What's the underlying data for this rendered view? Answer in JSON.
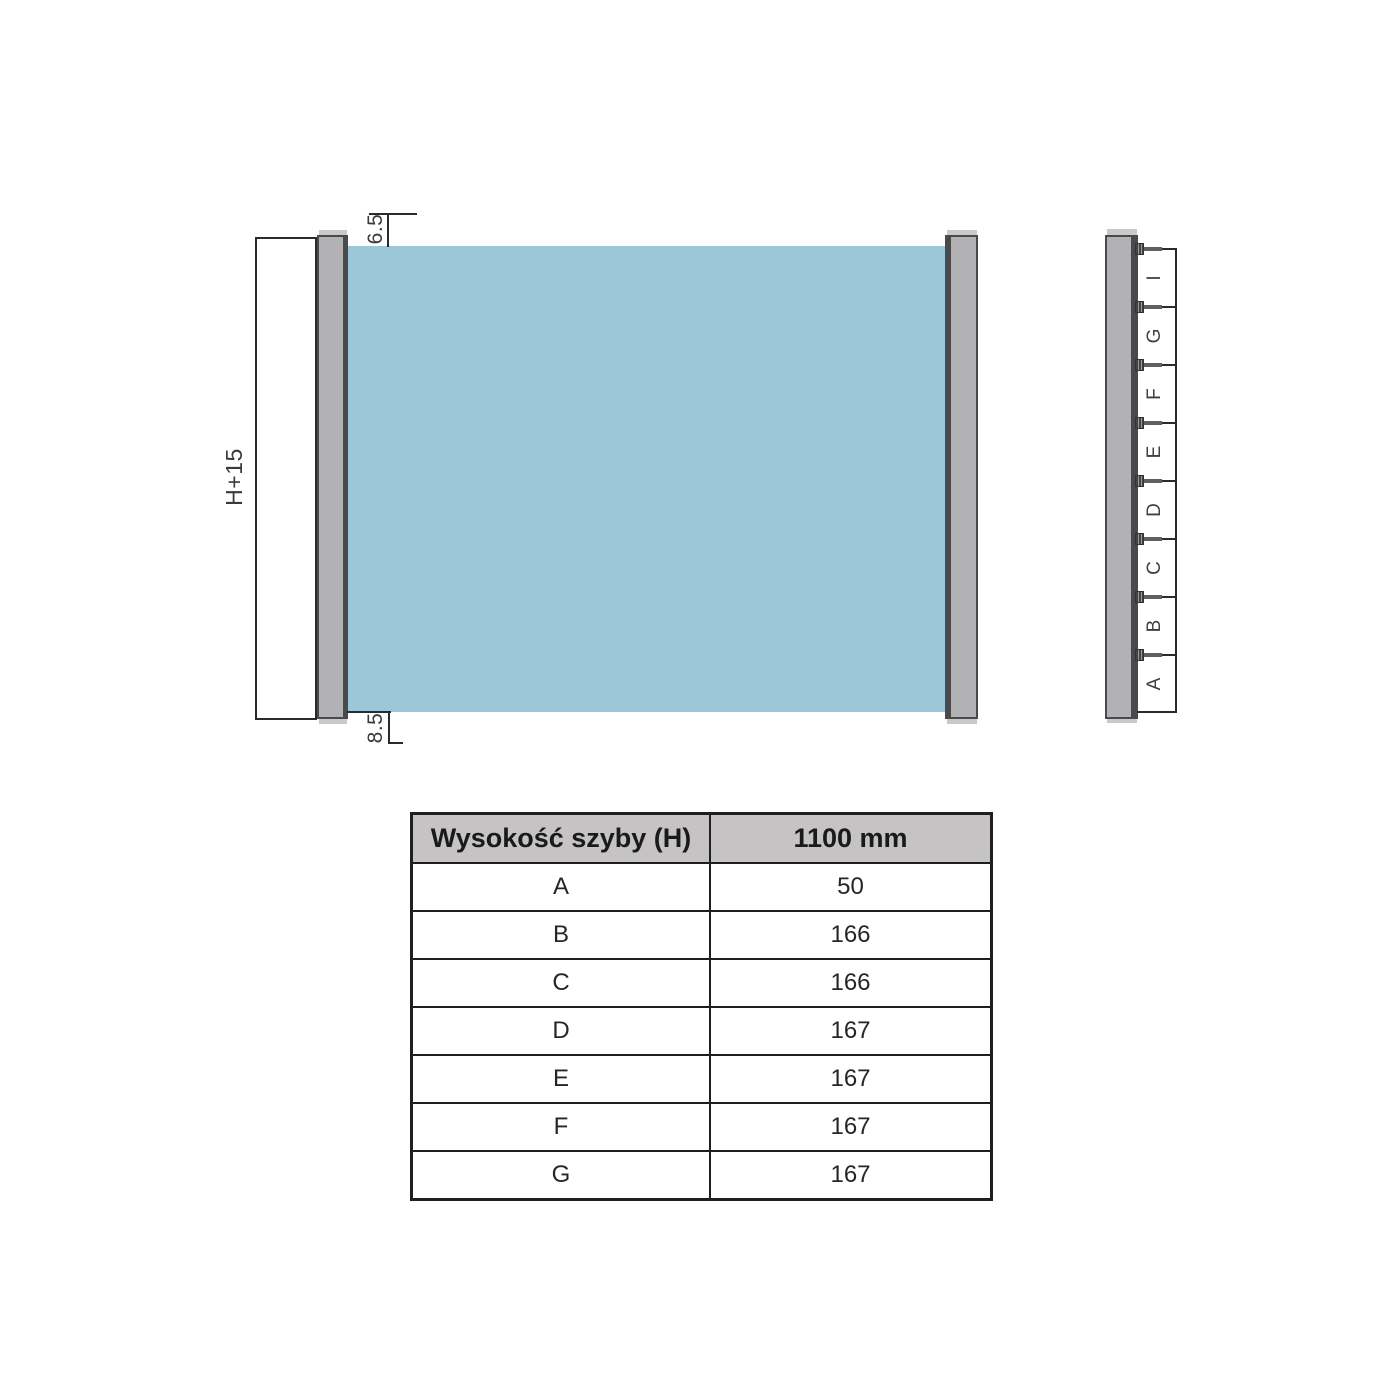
{
  "front_view": {
    "height_dim": "H+15",
    "top_gap_dim": "6.5",
    "bottom_gap_dim": "8.5"
  },
  "side_view": {
    "segments": [
      "I",
      "G",
      "F",
      "E",
      "D",
      "C",
      "B",
      "A"
    ],
    "screw_icon": "screw-bolt"
  },
  "table": {
    "col1_header": "Wysokość szyby (H)",
    "col2_header": "1100 mm",
    "rows": [
      {
        "label": "A",
        "value": "50"
      },
      {
        "label": "B",
        "value": "166"
      },
      {
        "label": "C",
        "value": "166"
      },
      {
        "label": "D",
        "value": "167"
      },
      {
        "label": "E",
        "value": "167"
      },
      {
        "label": "F",
        "value": "167"
      },
      {
        "label": "G",
        "value": "167"
      }
    ]
  },
  "colors": {
    "glass": "#9cc7d9",
    "profile": "#b2b2b4",
    "profile_edge": "#4a4a4c",
    "table_header_bg": "#c6c3c4",
    "line": "#2b2b2b"
  }
}
